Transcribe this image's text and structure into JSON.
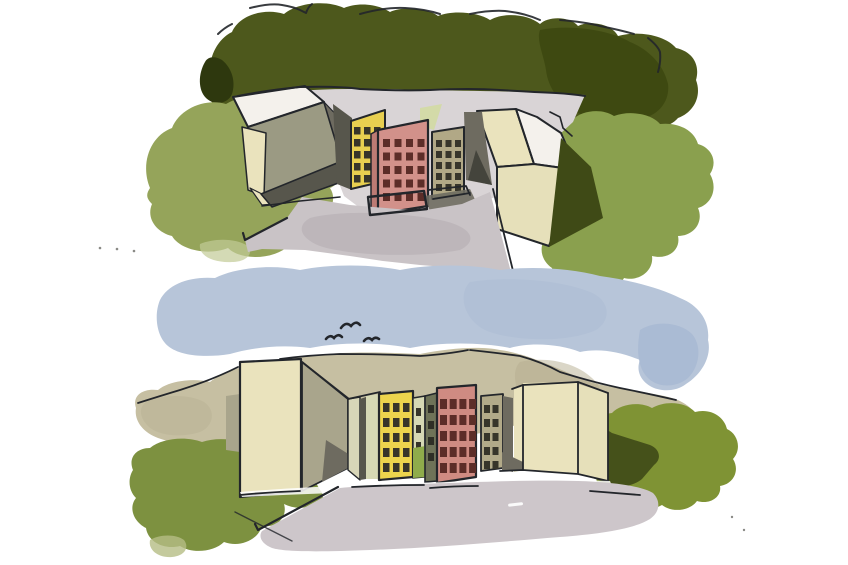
{
  "artwork": {
    "type": "watercolor-and-ink illustration",
    "description": "Two stacked watercolor sketches of the same modernist housing estate: top is an aerial courtyard view with three colored tower blocks framed by cream slab buildings, trees and bushes; bottom is a street-level view of the same towers behind a long cream wall under a blue sky with birds.",
    "scene_top": {
      "name": "aerial-courtyard-view",
      "elements": [
        "tree-mass",
        "left-bush",
        "right-bush",
        "courtyard-pavement",
        "left-slab-building",
        "right-slab-building",
        "yellow-tower",
        "pink-tower",
        "olive-tower",
        "access-road",
        "shadow-wedges"
      ]
    },
    "scene_bottom": {
      "name": "street-level-view",
      "elements": [
        "sky",
        "birds",
        "tan-backdrop",
        "left-bush",
        "right-bush",
        "dark-hedge",
        "cream-wall-left",
        "gray-wall",
        "yellow-building",
        "olive-sliver",
        "pink-building",
        "olive-building",
        "cream-wall-right",
        "road"
      ]
    },
    "birds_count": 3
  },
  "palette": {
    "paper": "#ffffff",
    "ink": "#23262b",
    "ink_soft": "#3a3f45",
    "tree": "#4d581c",
    "tree_dark": "#2e380e",
    "tree_shade": "#3c470f",
    "bush_tl": "#95a45a",
    "bush_tl_pale": "#c2cb96",
    "bush_tr": "#8aa04e",
    "shadow_olive": "#3f4a16",
    "pavement": "#d9d4d6",
    "road_top": "#c9c3c6",
    "road_blotch": "#b3acb0",
    "cream": "#eae3bd",
    "cream2": "#e6e0ba",
    "roof_white": "#f4f1ec",
    "roof_gray": "#9b9a83",
    "wedge_dark": "#57564c",
    "wedge_mid": "#6e6b60",
    "wedge_deep": "#44443c",
    "yellow_top": "#e8cf50",
    "pink_top": "#d2918a",
    "pink_side": "#bd7b74",
    "olive_top": "#b1a886",
    "win_dark": "#37352a",
    "win_red": "#5c2d28",
    "pale_green": "#d3daa8",
    "sky": "#b7c5d9",
    "sky_dark": "#a8b9d2",
    "tan": "#c6bfa2",
    "tan_dark": "#b5ae90",
    "bush_bl": "#7d9140",
    "bush_bl_pale": "#b5bd85",
    "bush_br": "#7f9334",
    "bush_br_dark": "#45511a",
    "gray_wall": "#a9a58c",
    "pale_wall": "#d8d6b8",
    "pale_sliver": "#d6d8b4",
    "olive_sliver": "#6f7358",
    "green_patch": "#8fac4b",
    "yellow_bot": "#ecd44d",
    "pink_bot": "#cf8b82",
    "pink_bot_side": "#b8746d",
    "olive_bot": "#b2aa89",
    "road_bot": "#cdc6ca",
    "speck": "#8a8a86"
  },
  "windows": {
    "yellow_top": {
      "x": 354,
      "y": 127,
      "cols": 3,
      "rows": 5,
      "w": 6.5,
      "h": 7.5,
      "dx": 10,
      "dy": 12,
      "fill": "#37352a"
    },
    "pink_top": {
      "x": 383,
      "y": 139,
      "cols": 4,
      "rows": 5,
      "w": 7,
      "h": 8,
      "dx": 11.5,
      "dy": 13.5,
      "fill": "#5c2d28"
    },
    "olive_top": {
      "x": 436,
      "y": 140,
      "cols": 3,
      "rows": 5,
      "w": 6,
      "h": 7,
      "dx": 9.5,
      "dy": 11,
      "fill": "#37352a"
    },
    "yellow_bot": {
      "x": 383,
      "y": 403,
      "cols": 3,
      "rows": 5,
      "w": 6.5,
      "h": 9,
      "dx": 10,
      "dy": 15,
      "fill": "#37352a"
    },
    "pale_sliver": {
      "x": 416,
      "y": 408,
      "cols": 1,
      "rows": 3,
      "w": 5,
      "h": 8,
      "dx": 0,
      "dy": 17,
      "fill": "#37352a"
    },
    "olive_sliver": {
      "x": 428,
      "y": 405,
      "cols": 1,
      "rows": 4,
      "w": 6,
      "h": 8,
      "dx": 0,
      "dy": 16,
      "fill": "#2f2f26"
    },
    "pink_bot": {
      "x": 440,
      "y": 399,
      "cols": 4,
      "rows": 5,
      "w": 7,
      "h": 10,
      "dx": 9.7,
      "dy": 16,
      "fill": "#5c2d28"
    },
    "olive_bot": {
      "x": 484,
      "y": 405,
      "cols": 2,
      "rows": 5,
      "w": 6,
      "h": 8,
      "dx": 8.5,
      "dy": 14,
      "fill": "#37352a"
    }
  }
}
